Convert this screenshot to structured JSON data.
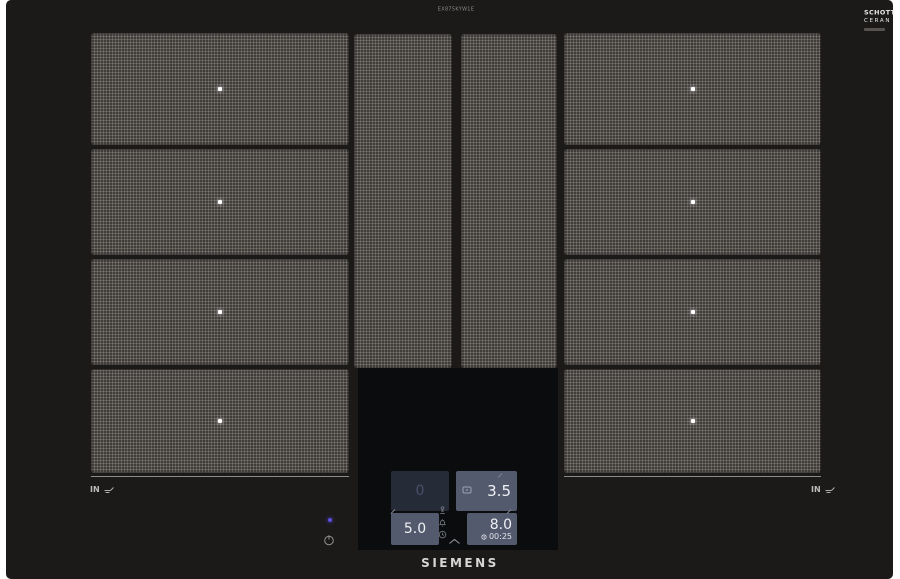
{
  "hob": {
    "model_label": "EX875KYW1E",
    "brand": "SIEMENS",
    "glass_badge": {
      "line1": "SCHOTT",
      "line2": "CERAN"
    },
    "left_marking": "IN",
    "right_marking": "IN",
    "surface_color": "#1c1a19",
    "zone_pattern_color": "#4a4744",
    "zone_marker_color": "#ffffff"
  },
  "control_panel": {
    "rear_left_display": {
      "value": "0"
    },
    "rear_right_display": {
      "value": "3.5",
      "icon": "pan-detected-icon"
    },
    "front_left_display": {
      "value": "5.0"
    },
    "front_right_display": {
      "value": "8.0",
      "timer": "00:25"
    },
    "function_icons": [
      "cooking-sensor-icon",
      "alarm-bell-icon",
      "timer-clock-icon"
    ],
    "chevron_icon": "chevron-up-icon",
    "power_icon": "power-icon",
    "tile_color": "#545a6d",
    "dim_tile_color": "#262b38",
    "value_color": "#eef0f4",
    "dim_value_color": "#49506a",
    "led_color": "#5c4ddd"
  }
}
